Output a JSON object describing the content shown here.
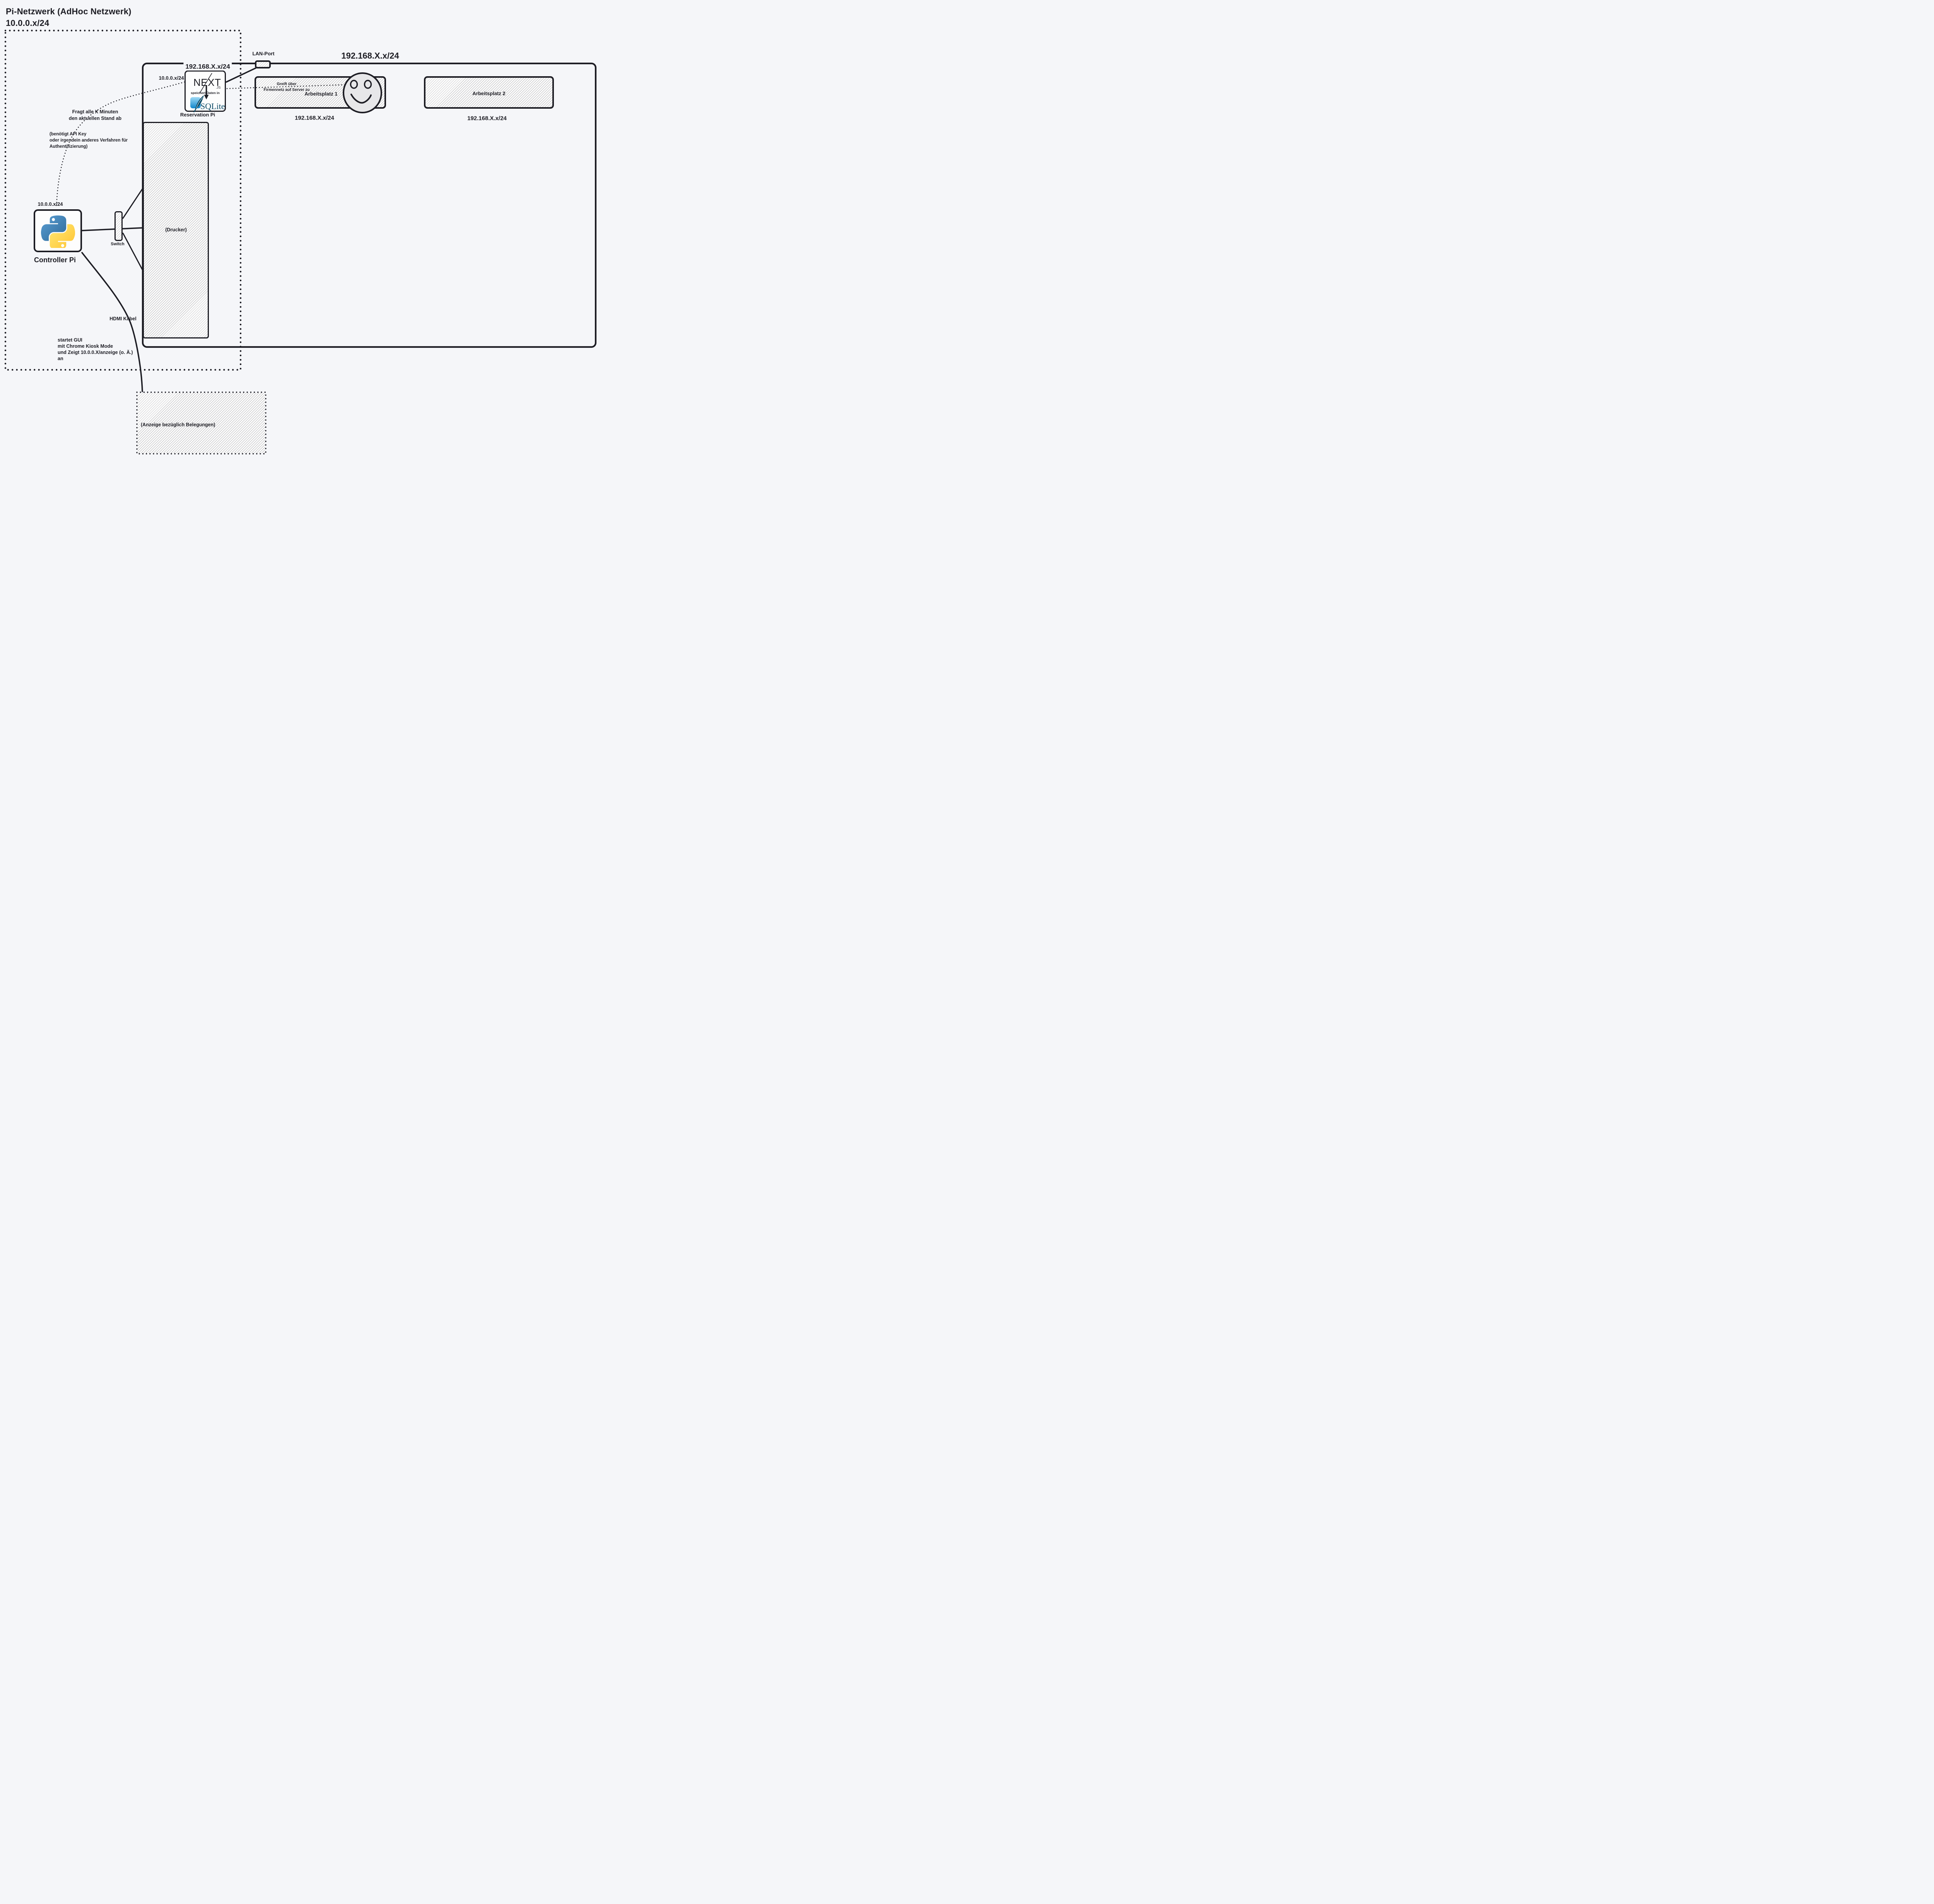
{
  "titles": {
    "line1": "Pi-Netzwerk (AdHoc Netzwerk)",
    "line2": "10.0.0.x/24"
  },
  "labels": {
    "lan_port": "LAN-Port",
    "subnet_company_top": "192.168.X.x/24",
    "subnet_above_server": "192.168.X.x/24",
    "subnet_pi_server": "10.0.0.x/24",
    "subnet_ap1": "192.168.X.x/24",
    "subnet_ap2": "192.168.X.x/24",
    "subnet_controller": "10.0.0.x/24"
  },
  "nodes": {
    "reservation_pi": {
      "name": "Reservation Pi",
      "framework": "NEXT",
      "framework_suffix": ".JS",
      "stores_text": "speichert Daten in",
      "database": "SQLite"
    },
    "arbeitsplatz1": {
      "name": "Arbeitsplatz 1",
      "note1": "Greift über",
      "note2": "Firmennetz auf Server zu"
    },
    "arbeitsplatz2": {
      "name": "Arbeitsplatz 2"
    },
    "drucker": {
      "name": "(Drucker)"
    },
    "controller_pi": {
      "name": "Controller Pi"
    },
    "switch": {
      "name": "Switch"
    },
    "anzeige": {
      "name": "(Anzeige bezüglich Belegungen)"
    }
  },
  "annotations": {
    "poll_line1": "Fragt alle X Minuten",
    "poll_line2": "den aktuellen Stand ab",
    "api_line1": "(benötigt API Key",
    "api_line2": "oder irgendein anderes Verfahren für",
    "api_line3": "Authentifizierung)",
    "hdmi": "HDMI Kabel",
    "gui_line1": "startet GUI",
    "gui_line2": "mit Chrome Kiosk Mode",
    "gui_line3": "und Zeigt 10.0.0.X/anzeige (o. Ä.)",
    "gui_line4": "an"
  },
  "colors": {
    "ink": "#1d1d24",
    "background": "#f5f6f9",
    "python_blue": "#387EB8",
    "python_yellow": "#FFD43B",
    "sqlite_blue_light": "#9ed9f5",
    "sqlite_blue_dark": "#1287cc",
    "sqlite_text": "#0b4a66",
    "smiley_fill": "#e7e7e9"
  }
}
